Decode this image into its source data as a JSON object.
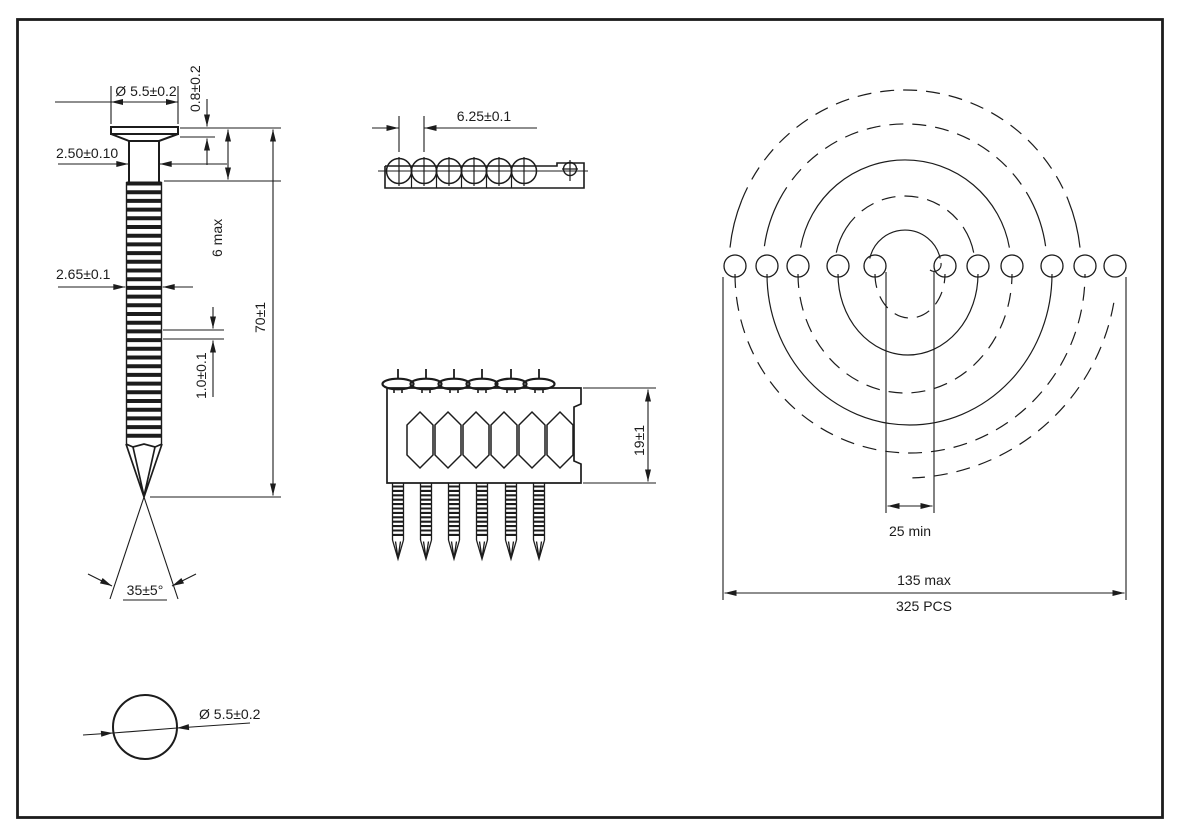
{
  "nail_view": {
    "head_diameter": "Ø 5.5±0.2",
    "head_height": "0.8±0.2",
    "shank_diameter": "2.50±0.10",
    "ring_diameter": "2.65±0.1",
    "smooth_length": "6 max",
    "overall_length": "70±1",
    "ring_pitch": "1.0±0.1",
    "point_angle": "35±5°"
  },
  "head_top_view": {
    "head_diameter": "Ø 5.5±0.2"
  },
  "strip_top_view": {
    "nail_pitch": "6.25±0.1"
  },
  "strip_side_view": {
    "strip_height": "19±1"
  },
  "coil_view": {
    "inner_diameter": "25 min",
    "outer_diameter": "135 max",
    "piece_count": "325 PCS"
  },
  "colors": {
    "line": "#1c1c1c",
    "background": "#ffffff"
  }
}
